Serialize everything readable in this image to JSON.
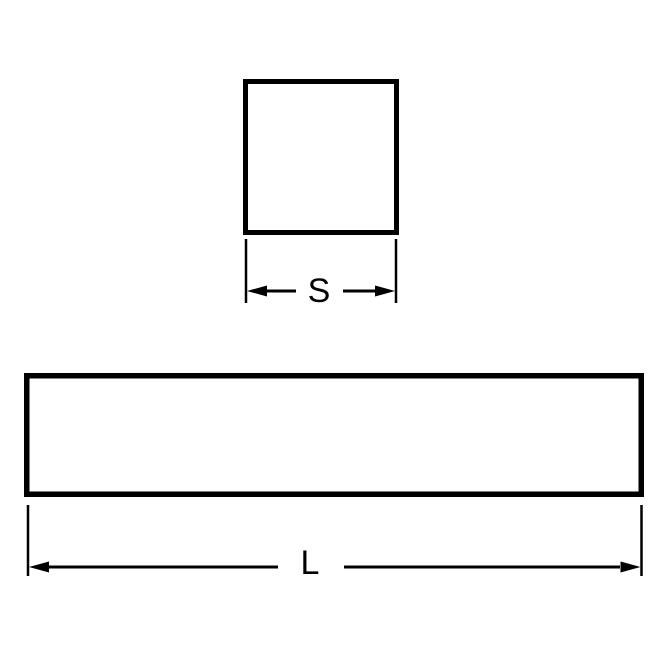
{
  "page": {
    "background_color": "#ffffff"
  },
  "drawing": {
    "line_color": "#000000",
    "square_view": {
      "dimension_label": "S"
    },
    "length_view": {
      "dimension_label": "L"
    }
  }
}
